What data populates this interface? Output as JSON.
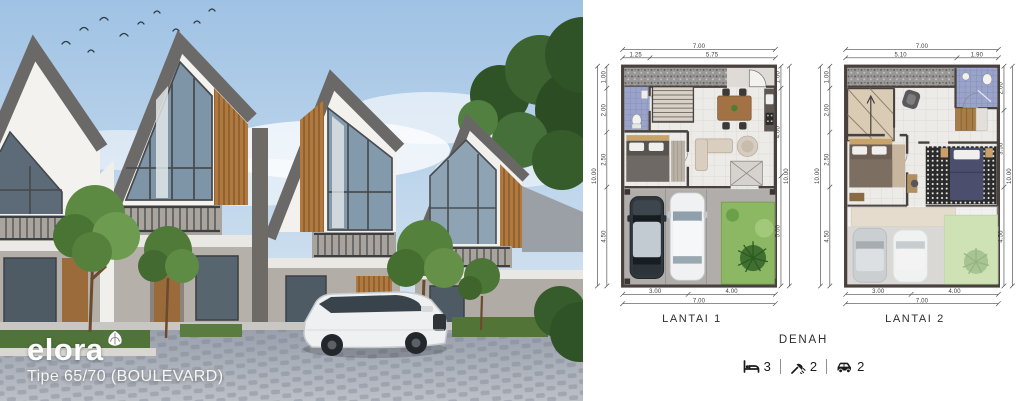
{
  "hero": {
    "logo_text": "elora",
    "tagline": "Tipe 65/70 (BOULEVARD)"
  },
  "plans": [
    {
      "label": "LANTAI 1",
      "dims": {
        "top_total": "7.00",
        "top_segments": [
          "1.25",
          "5.75"
        ],
        "left_total": "10.00",
        "left_segments": [
          "1.00",
          "2.00",
          "2.50",
          "4.50"
        ],
        "right_total": "10.00",
        "right_segments": [
          "1.00",
          "4.00",
          "5.00"
        ],
        "bottom_total": "7.00",
        "bottom_segments": [
          "3.00",
          "4.00"
        ]
      }
    },
    {
      "label": "LANTAI 2",
      "dims": {
        "top_total": "7.00",
        "top_segments": [
          "5.10",
          "1.90"
        ],
        "left_total": "10.00",
        "left_segments": [
          "1.00",
          "2.00",
          "2.50",
          "4.50"
        ],
        "right_total": "10.00",
        "right_segments": [
          "2.00",
          "3.50",
          "4.50"
        ],
        "bottom_total": "7.00",
        "bottom_segments": [
          "3.00",
          "4.00"
        ]
      }
    }
  ],
  "caption": "DENAH",
  "stats": [
    {
      "name": "bedrooms",
      "value": "3"
    },
    {
      "name": "bathrooms",
      "value": "2"
    },
    {
      "name": "carports",
      "value": "2"
    }
  ],
  "colors": {
    "sky": "#a6c6e6",
    "wood_accent": "#b0793f",
    "plan_wall": "#48413d",
    "bathroom_tile": "#9aa3c9",
    "garden_green": "#8cb763",
    "logo_text_color": "#ffffff"
  }
}
